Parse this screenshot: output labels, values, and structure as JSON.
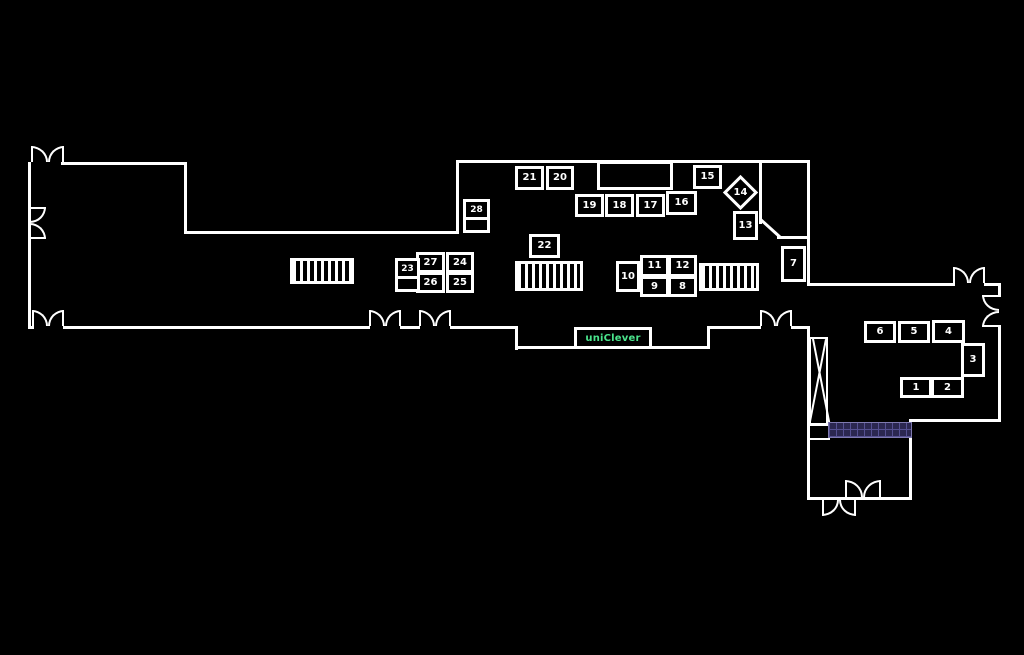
{
  "plan": {
    "brand_sign": {
      "label": "uniClever",
      "color": "#4ae48c"
    },
    "stands": {
      "s1": "1",
      "s2": "2",
      "s3": "3",
      "s4": "4",
      "s5": "5",
      "s6": "6",
      "s7": "7",
      "s8": "8",
      "s9": "9",
      "s10": "10",
      "s11": "11",
      "s12": "12",
      "s13": "13",
      "s14": "14",
      "s15": "15",
      "s16": "16",
      "s17": "17",
      "s18": "18",
      "s19": "19",
      "s20": "20",
      "s21": "21",
      "s22": "22",
      "s23": "23",
      "s24": "24",
      "s25": "25",
      "s26": "26",
      "s27": "27",
      "s28": "28"
    },
    "colors": {
      "background": "#000000",
      "walls": "#ffffff",
      "stand_numbers": "#ffffff",
      "brand_green": "#4ae48c",
      "highlight_panel_fill": "#2b2750",
      "highlight_panel_lines": "#555091"
    },
    "icons": {
      "stairs": "x-cross-icon",
      "hatch_block": "striped-rect-icon",
      "door": "double-swing-door-arc-icon"
    }
  }
}
